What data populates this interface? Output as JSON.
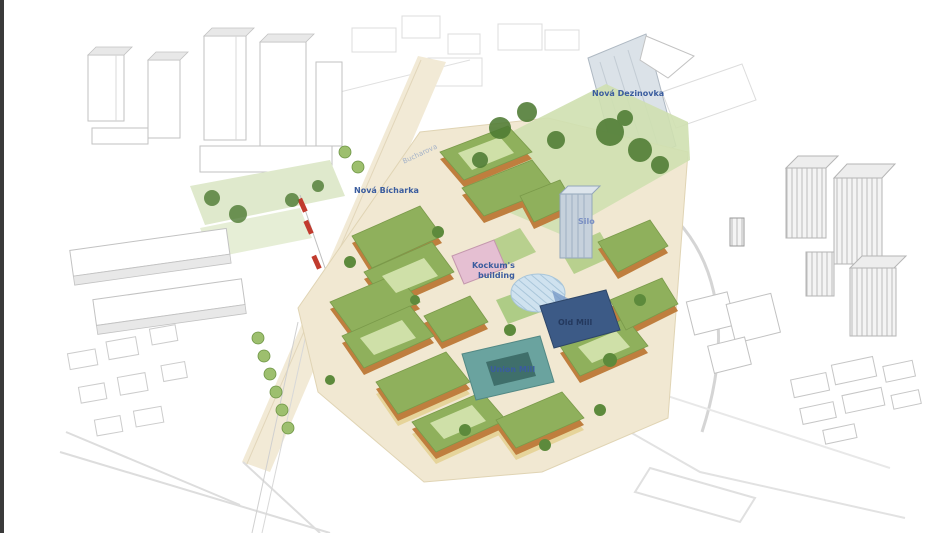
{
  "meta": {
    "description": "Aerial axonometric hand-drawn masterplan sketch of an urban redevelopment district with green-roofed perimeter blocks, parks, a tram street and heritage industrial buildings",
    "canvas": {
      "width": 950,
      "height": 533
    }
  },
  "labels": {
    "nova_dezinovka": {
      "text": "Nová Dezinovka"
    },
    "station": {
      "text": "Nová Bícharka"
    },
    "street": {
      "text": "Bucharova"
    },
    "silo": {
      "text": "Silo"
    },
    "central_line1": {
      "text": "Kockum's"
    },
    "central_line2": {
      "text": "building"
    },
    "old_mill": {
      "text": "Old Mill"
    },
    "union_mill": {
      "text": "Union Mill"
    }
  },
  "palette": {
    "label_blue": "#3a5c9e",
    "label_light_blue": "#7b90c4",
    "roof_green": "#8fb05c",
    "park_green": "#cfe0b0",
    "tree_green": "#4e7b33",
    "facade_orange": "#bf7e3e",
    "cream": "#e6d49a",
    "ground_beige": "#f1e8d2",
    "silo_grey_blue": "#c6d1dc",
    "old_mill_navy": "#3c5a86",
    "union_mill_teal": "#6aa39f",
    "plaza_blue": "#cfe2ef",
    "pink_building": "#e5bfd2",
    "rail_red": "#c13b2e",
    "sketch_grey": "#c2c2c2",
    "edge_bar": "#3a3a3a"
  }
}
